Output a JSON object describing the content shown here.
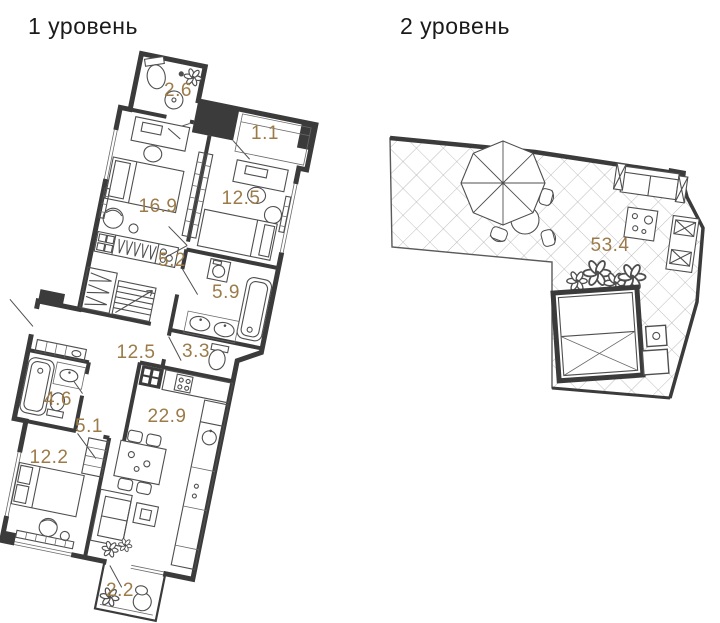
{
  "colors": {
    "area_label": "#9c7b49",
    "wall": "#3b3b3b",
    "furniture_line": "#4f4f4f",
    "hatch_line": "#a9a9a9",
    "title": "#1a1a1a"
  },
  "levels": [
    {
      "title": "1 уровень",
      "rooms": [
        {
          "name": "bathroom-top",
          "area": "2.6"
        },
        {
          "name": "loggia-top",
          "area": "1.1"
        },
        {
          "name": "bedroom-right",
          "area": "12.5"
        },
        {
          "name": "bedroom-left",
          "area": "16.9"
        },
        {
          "name": "corridor-wardrobe",
          "area": "5.2"
        },
        {
          "name": "bathroom-middle",
          "area": "5.9"
        },
        {
          "name": "hallway",
          "area": "12.5"
        },
        {
          "name": "wc",
          "area": "3.3"
        },
        {
          "name": "bathroom-lower",
          "area": "4.6"
        },
        {
          "name": "corridor-lower",
          "area": "5.1"
        },
        {
          "name": "kitchen-living",
          "area": "22.9"
        },
        {
          "name": "bedroom-lower",
          "area": "12.2"
        },
        {
          "name": "balcony",
          "area": "2.2"
        }
      ]
    },
    {
      "title": "2 уровень",
      "rooms": [
        {
          "name": "terrace",
          "area": "53.4"
        }
      ]
    }
  ]
}
